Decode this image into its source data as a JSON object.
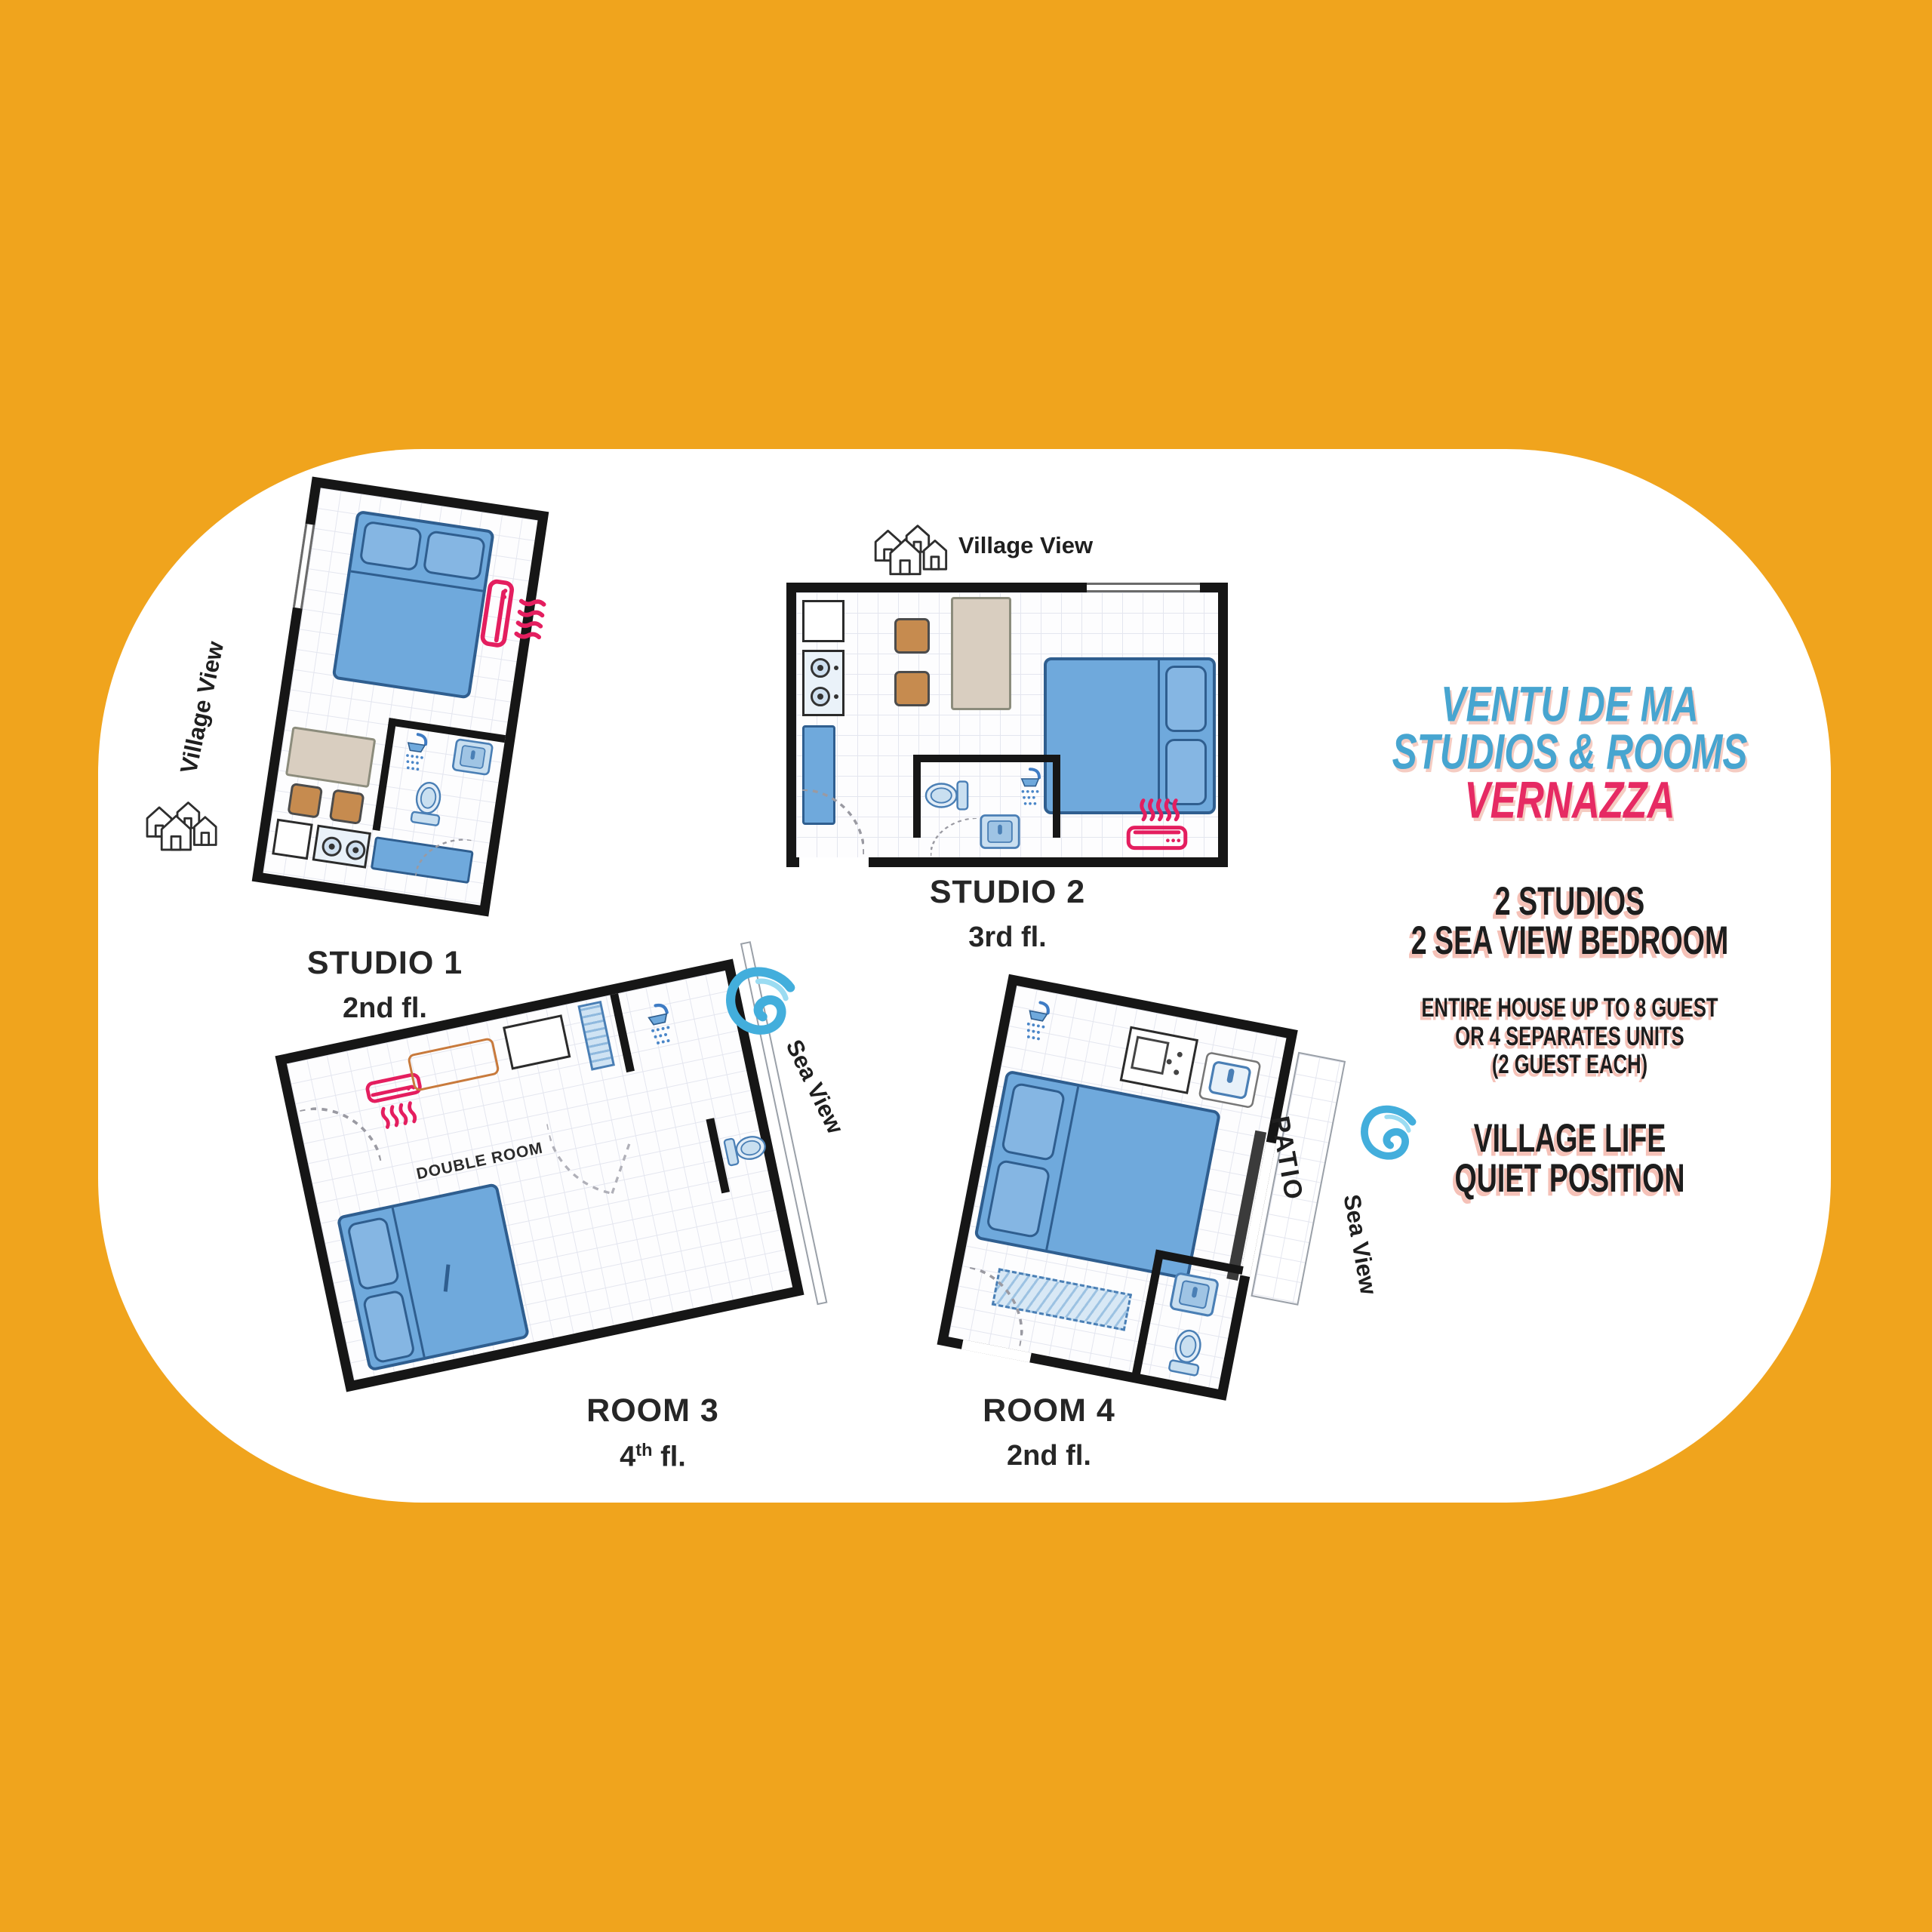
{
  "title": {
    "line1": "VENTU DE MA",
    "line2": "STUDIOS & ROOMS",
    "line3": "VERNAZZA"
  },
  "info": {
    "cap1": "2 STUDIOS",
    "cap2": "2 SEA VIEW BEDROOM",
    "house1": "ENTIRE HOUSE UP TO 8 GUEST",
    "house2": "OR 4 SEPARATES UNITS",
    "house3": "(2 GUEST EACH)",
    "village1": "VILLAGE LIFE",
    "village2": "QUIET POSITION"
  },
  "plans": {
    "studio1": {
      "name": "STUDIO 1",
      "floor": "2nd fl.",
      "view": "Village View"
    },
    "studio2": {
      "name": "STUDIO 2",
      "floor": "3rd fl.",
      "view": "Village View"
    },
    "room3": {
      "name": "ROOM 3",
      "floor_num": "4",
      "floor_sup": "th",
      "floor_rest": " fl.",
      "room_label": "DOUBLE ROOM",
      "view": "Sea View"
    },
    "room4": {
      "name": "ROOM 4",
      "floor": "2nd fl.",
      "view": "Sea View",
      "patio": "PATIO"
    }
  },
  "colors": {
    "background": "#F0A41D",
    "panel": "#FFFFFF",
    "title_blue": "#47A5D0",
    "title_pink": "#E62A63",
    "icon_pink": "#E41E5F",
    "furniture_blue": "#6FA9DC",
    "wall_black": "#161616"
  }
}
